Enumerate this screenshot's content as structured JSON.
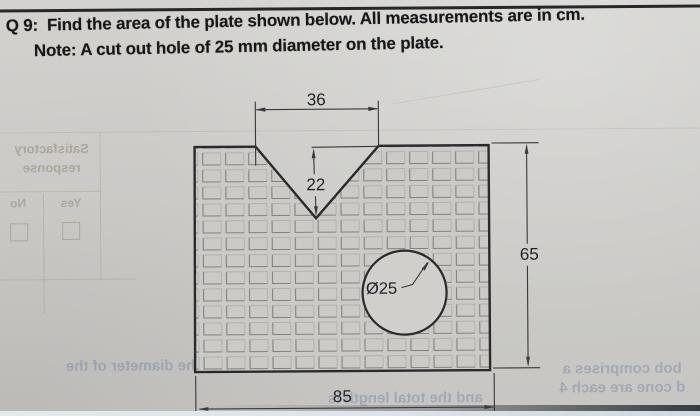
{
  "page": {
    "q_label": "Q 9:",
    "q_text": "Find the area of the plate shown below. All measurements are in cm.",
    "note": "Note: A cut out hole of 25 mm diameter on the plate."
  },
  "diagram": {
    "type": "technical-drawing",
    "units": "cm",
    "dims": {
      "top_width": "36",
      "notch_depth": "22",
      "height": "65",
      "width": "85",
      "hole": "Ø25"
    }
  },
  "bleed": {
    "satisfactory": "Satisfactory",
    "response": "response",
    "no": "No",
    "yes": "Yes",
    "diameter_line": "the diameter of the",
    "total_length_line": "and the total length is",
    "right_line1": "bob comprises a",
    "right_line2": "d cone are each 4"
  },
  "colors": {
    "paper": "#cccbc8",
    "ink": "#161616",
    "outline": "#2a2a2c",
    "dimension": "#38383a",
    "bleed_warm": "#93897a",
    "bleed_blue": "#71809c"
  }
}
